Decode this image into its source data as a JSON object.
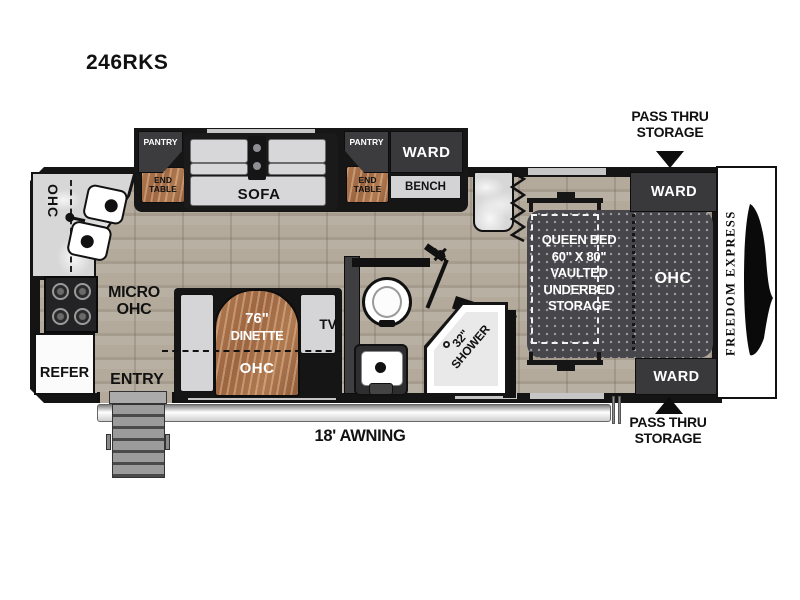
{
  "title": "246RKS",
  "colors": {
    "wall": "#141414",
    "floor": "#b3aa9c",
    "wood": "#a9744e",
    "furniture_light": "#d5d5d7",
    "furniture_dark": "#3c3c3f",
    "bed": "#46464b",
    "counter_marble": "#d7d7d7"
  },
  "exterior": {
    "pass_thru_top": {
      "line1": "PASS THRU",
      "line2": "STORAGE"
    },
    "pass_thru_bottom": {
      "line1": "PASS THRU",
      "line2": "STORAGE"
    },
    "awning": "18' AWNING",
    "entry": "ENTRY",
    "brand": "FREEDOM EXPRESS"
  },
  "living": {
    "pantry_left": "PANTRY",
    "end_table_left": "END TABLE",
    "sofa": "SOFA",
    "pantry_right": "PANTRY",
    "end_table_right": "END TABLE",
    "ward": "WARD",
    "bench": "BENCH",
    "tv": "TV",
    "dinette_size": "76\"",
    "dinette": "DINETTE",
    "dinette_ohc": "OHC"
  },
  "kitchen": {
    "ohc": "OHC",
    "micro_line1": "MICRO",
    "micro_line2": "OHC",
    "refer": "REFER"
  },
  "bath": {
    "shower_size": "32\"",
    "shower": "SHOWER"
  },
  "bedroom": {
    "bed_line1": "QUEEN BED",
    "bed_line2": "60\" X 80\"",
    "bed_line3": "VAULTED",
    "bed_line4": "UNDERBED",
    "bed_line5": "STORAGE",
    "ohc": "OHC",
    "ward_top": "WARD",
    "ward_bottom": "WARD"
  }
}
